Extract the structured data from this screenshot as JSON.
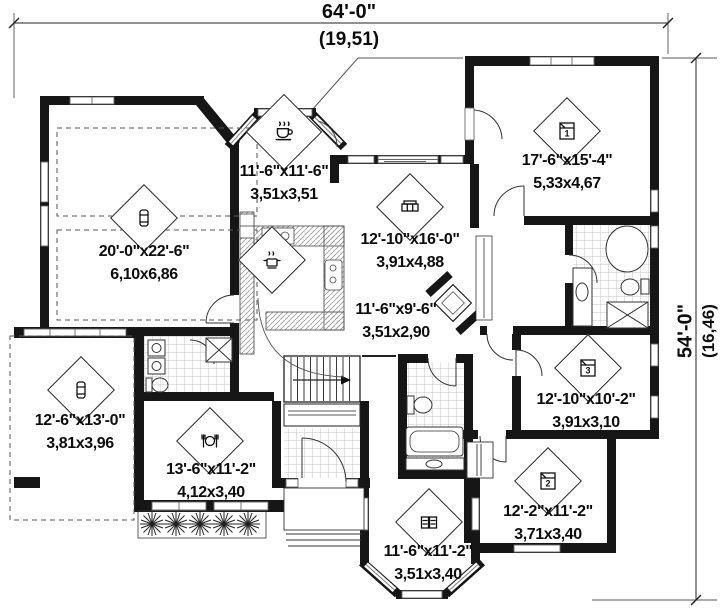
{
  "plan": {
    "type": "floor-plan",
    "dimensions": {
      "width_imperial": "64'-0\"",
      "width_metric": "(19,51)",
      "depth_imperial": "54'-0\"",
      "depth_metric": "(16,46)"
    },
    "rooms": [
      {
        "id": "breakfast",
        "icon": "coffee-cup",
        "imperial": "11'-6\"x11'-6\"",
        "metric": "3,51x3,51"
      },
      {
        "id": "garage",
        "icon": "car",
        "imperial": "20'-0\"x22'-6\"",
        "metric": "6,10x6,86"
      },
      {
        "id": "living-room",
        "icon": "sofa",
        "imperial": "12'-10\"x16'-0\"",
        "metric": "3,91x4,88"
      },
      {
        "id": "master-bedroom",
        "icon": "bed",
        "number": "1",
        "imperial": "17'-6\"x15'-4\"",
        "metric": "5,33x4,67"
      },
      {
        "id": "dinette",
        "icon": null,
        "imperial": "11'-6\"x9'-6\"",
        "metric": "3,51x2,90"
      },
      {
        "id": "kitchen",
        "icon": "cooking-pot"
      },
      {
        "id": "parking",
        "icon": "car",
        "imperial": "12'-6\"x13'-0\"",
        "metric": "3,81x3,96"
      },
      {
        "id": "dining-room",
        "icon": "plate-cutlery",
        "imperial": "13'-6\"x11'-2\"",
        "metric": "4,12x3,40"
      },
      {
        "id": "bedroom-3",
        "icon": "bed",
        "number": "3",
        "imperial": "12'-10\"x10'-2\"",
        "metric": "3,91x3,10"
      },
      {
        "id": "bedroom-2",
        "icon": "bed",
        "number": "2",
        "imperial": "12'-2\"x11'-2\"",
        "metric": "3,71x3,40"
      },
      {
        "id": "office",
        "icon": "books",
        "imperial": "11'-6\"x11'-2\"",
        "metric": "3,51x3,40"
      }
    ]
  }
}
